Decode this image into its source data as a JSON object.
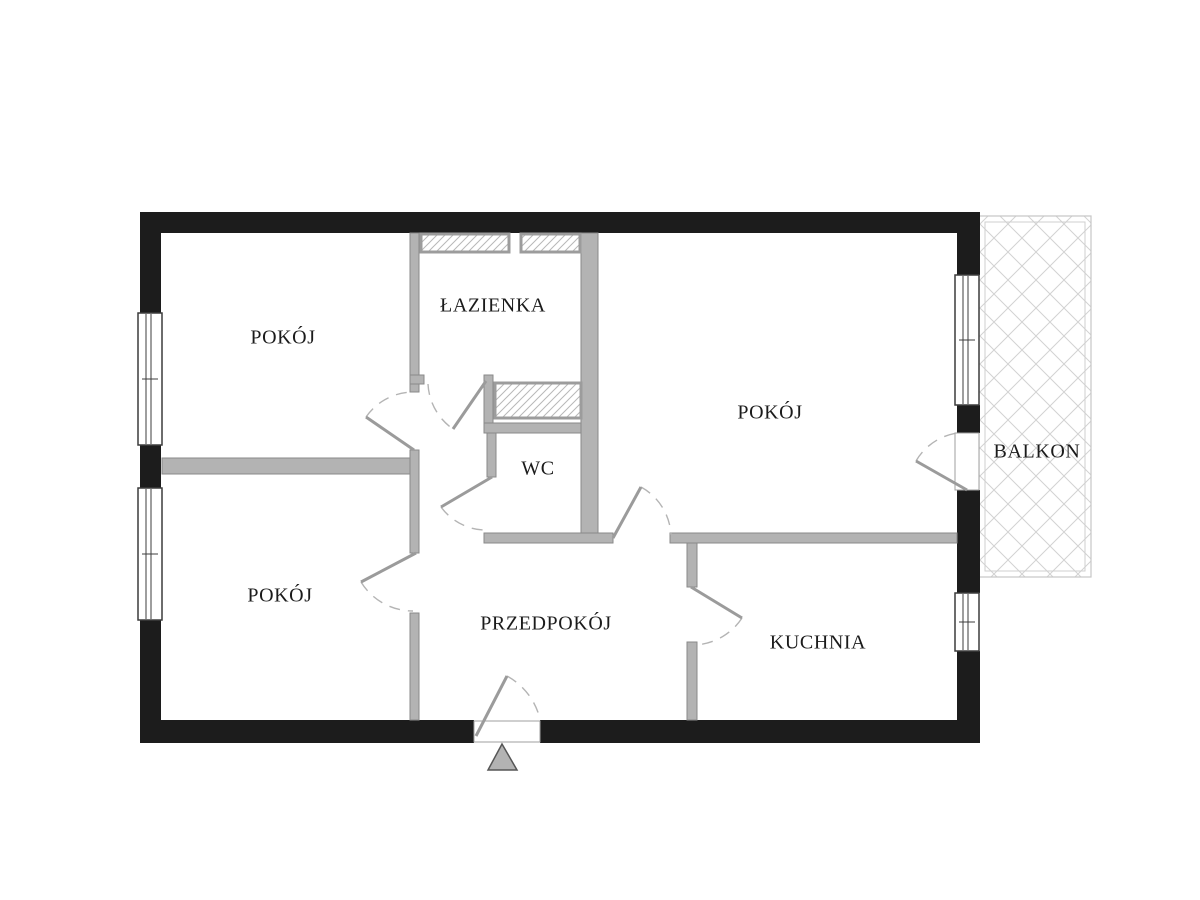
{
  "plan": {
    "labels": {
      "room_top_left": "POKÓJ",
      "bathroom": "ŁAZIENKA",
      "room_right": "POKÓJ",
      "wc": "WC",
      "room_bottom_left": "POKÓJ",
      "hallway": "PRZEDPOKÓJ",
      "kitchen": "KUCHNIA",
      "balcony": "BALKON"
    }
  },
  "colors": {
    "wall_black": "#1c1c1c",
    "wall_gray": "#b3b3b3",
    "wall_gray_edge": "#8a8a8a"
  }
}
